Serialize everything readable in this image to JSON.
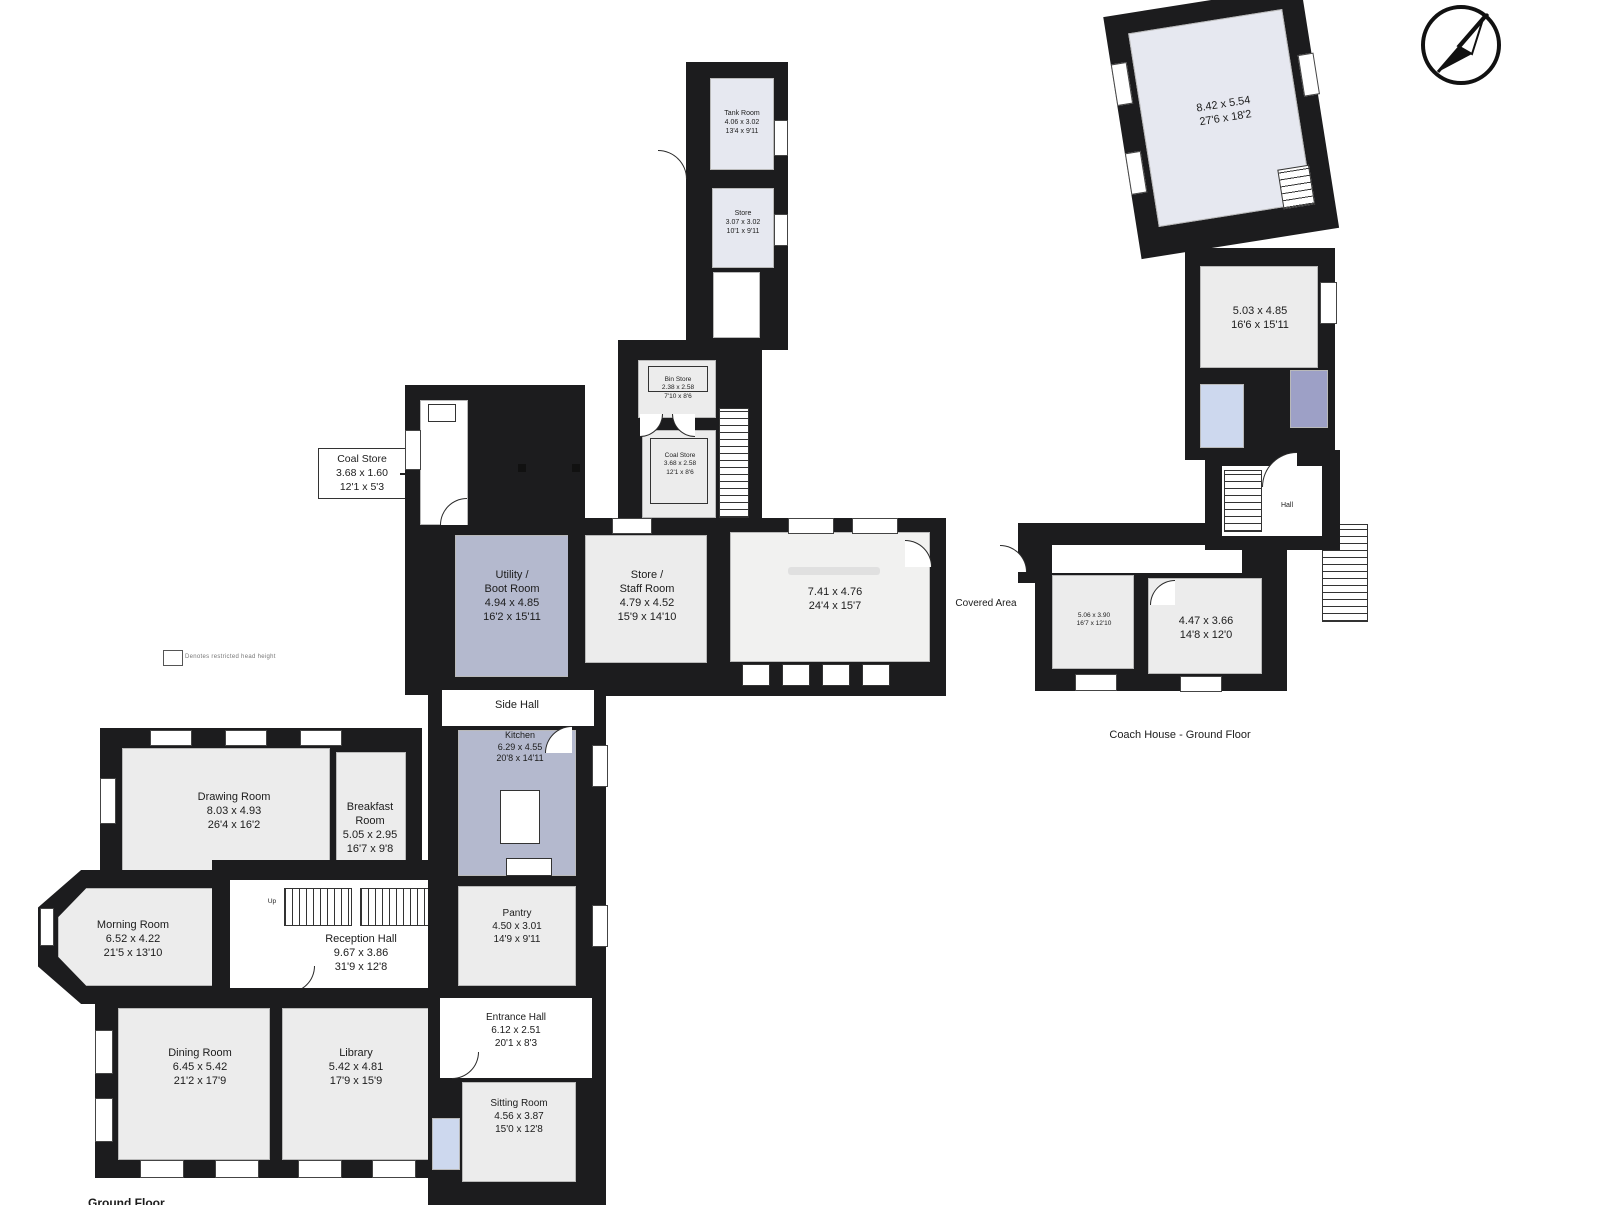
{
  "colors": {
    "wall": "#1c1c1e",
    "room_light": "#ececec",
    "room_tint": "#e6e8f0",
    "room_lavender": "#b4b9ce",
    "room_blue": "#cdd8ee",
    "room_purple": "#9da0c6"
  },
  "labels": {
    "side_hall": "Side Hall",
    "hall": "Hall",
    "covered_area": "Covered Area",
    "coach_house_ground": "Coach House - Ground Floor",
    "up": "Up",
    "legend_note": "Denotes restricted head height",
    "ground_floor": "Ground Floor"
  },
  "callout": {
    "name": "Coal Store",
    "m": "3.68 x 1.60",
    "ft": "12'1 x 5'3"
  },
  "rooms": {
    "tank_room": {
      "name": "Tank Room",
      "m": "4.06 x 3.02",
      "ft": "13'4 x 9'11"
    },
    "store_upper": {
      "name": "Store",
      "m": "3.07 x 3.02",
      "ft": "10'1 x 9'11"
    },
    "bin_store": {
      "name": "Bin Store",
      "m": "2.38 x 2.58",
      "ft": "7'10 x 8'6"
    },
    "coal_store": {
      "name": "Coal Store",
      "m": "3.68 x 2.58",
      "ft": "12'1 x 8'6"
    },
    "utility_boot": {
      "name": "Utility /\nBoot Room",
      "m": "4.94 x 4.85",
      "ft": "16'2 x 15'11"
    },
    "store_staff": {
      "name": "Store /\nStaff Room",
      "m": "4.79 x 4.52",
      "ft": "15'9 x 14'10"
    },
    "main_room": {
      "name": "",
      "m": "7.41 x 4.76",
      "ft": "24'4 x 15'7"
    },
    "coach_large": {
      "name": "",
      "m": "8.42 x 5.54",
      "ft": "27'6 x 18'2"
    },
    "coach_mid": {
      "name": "",
      "m": "5.03 x 4.85",
      "ft": "16'6 x 15'11"
    },
    "coach_small_left": {
      "name": "",
      "m": "5.06 x 3.90",
      "ft": "16'7 x 12'10"
    },
    "coach_small_right": {
      "name": "",
      "m": "4.47 x 3.66",
      "ft": "14'8 x 12'0"
    },
    "kitchen": {
      "name": "Kitchen",
      "m": "6.29 x 4.55",
      "ft": "20'8 x 14'11"
    },
    "pantry": {
      "name": "Pantry",
      "m": "4.50 x 3.01",
      "ft": "14'9 x 9'11"
    },
    "drawing_room": {
      "name": "Drawing Room",
      "m": "8.03 x 4.93",
      "ft": "26'4 x 16'2"
    },
    "breakfast_room": {
      "name": "Breakfast\nRoom",
      "m": "5.05 x 2.95",
      "ft": "16'7 x 9'8"
    },
    "morning_room": {
      "name": "Morning Room",
      "m": "6.52 x 4.22",
      "ft": "21'5 x 13'10"
    },
    "reception_hall": {
      "name": "Reception Hall",
      "m": "9.67 x 3.86",
      "ft": "31'9 x 12'8"
    },
    "entrance_hall": {
      "name": "Entrance Hall",
      "m": "6.12 x 2.51",
      "ft": "20'1 x 8'3"
    },
    "dining_room": {
      "name": "Dining Room",
      "m": "6.45 x 5.42",
      "ft": "21'2 x 17'9"
    },
    "library": {
      "name": "Library",
      "m": "5.42 x 4.81",
      "ft": "17'9 x 15'9"
    },
    "sitting_room": {
      "name": "Sitting Room",
      "m": "4.56 x 3.87",
      "ft": "15'0 x 12'8"
    }
  }
}
